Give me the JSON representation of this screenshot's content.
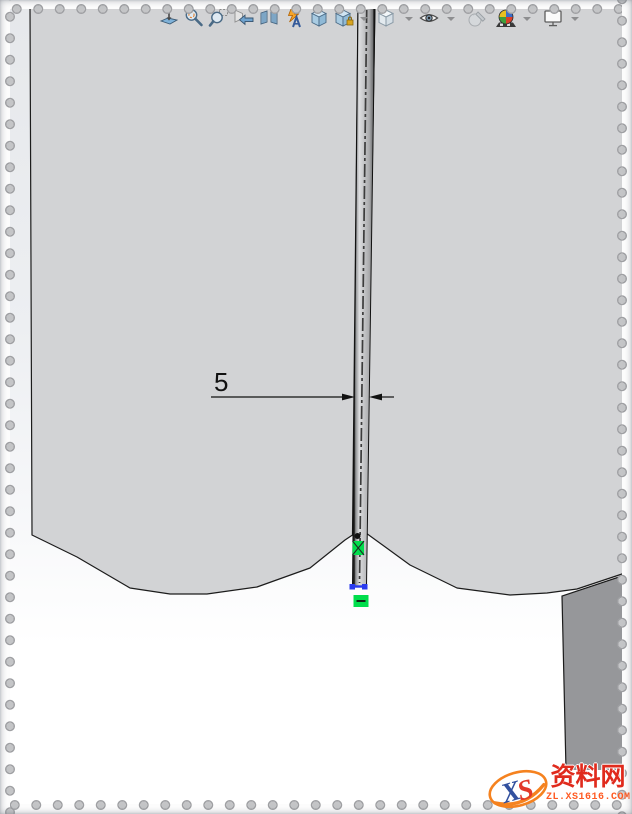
{
  "app": {
    "name": "SolidWorks 3D viewport"
  },
  "toolbar": {
    "items": [
      {
        "name": "zoom-to-fit"
      },
      {
        "name": "zoom"
      },
      {
        "name": "zoom-to-area"
      },
      {
        "name": "previous-view"
      },
      {
        "name": "section-view"
      },
      {
        "name": "hide-show-annotations"
      },
      {
        "name": "view-orientation"
      },
      {
        "name": "standard-views"
      },
      {
        "name": "display-style"
      },
      {
        "name": "hide-show-items"
      },
      {
        "name": "edit-appearance"
      },
      {
        "name": "apply-scene"
      },
      {
        "name": "view-settings"
      }
    ]
  },
  "viewport": {
    "dimension": {
      "value": "5"
    },
    "sketch_relation": "horizontal"
  },
  "watermark": {
    "logo_text_x": "X",
    "logo_text_s": "S",
    "site_name": "资料网",
    "site_url": "ZL.XS1616.COM"
  },
  "colors": {
    "selection_green": "#00dd4c",
    "endpoint_blue": "#2a3bee",
    "dimension_black": "#111111",
    "body_gray": "#d2d3d5",
    "side_face_gray": "#96979a",
    "watermark_red": "#e02b1d",
    "watermark_orange": "#ff5a22",
    "logo_blue": "#33519f",
    "logo_red": "#e2392a"
  }
}
